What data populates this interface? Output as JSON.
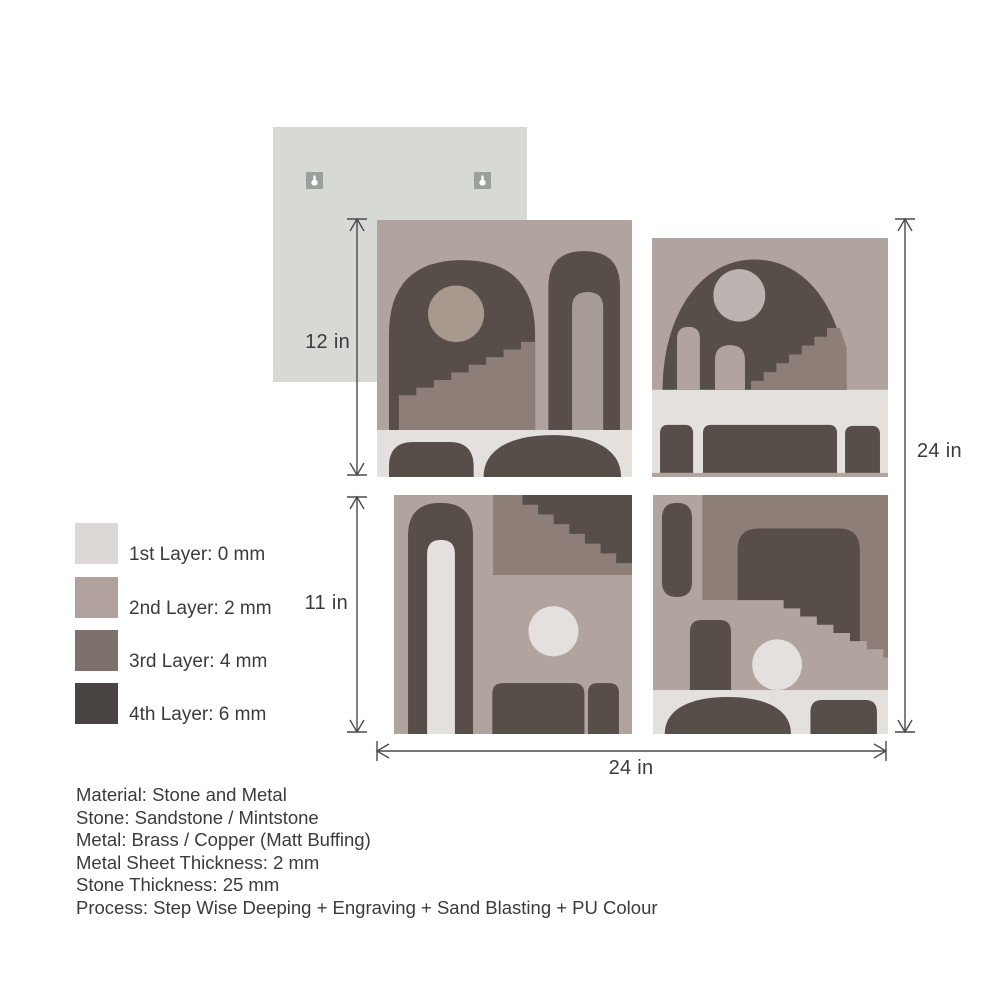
{
  "palette": {
    "layer1": "#e4e0dd",
    "layer2": "#b1a39e",
    "layer3": "#8d7e78",
    "layer4": "#574d49",
    "inner_arch": "#a79b96",
    "circle_dark_tile": "#a8998f",
    "circle_light": "#bcb2af",
    "legend1": "#dcd8d5",
    "legend2": "#b1a29d",
    "legend3": "#7e706b",
    "legend4": "#494341",
    "backing": "#d7d9d4",
    "hook": "#9aa09c",
    "line": "#4a4a4a",
    "text": "#3b3b3b"
  },
  "dimensions": {
    "top_left_tile_height": "12 in",
    "bottom_left_tile_height": "11 in",
    "total_height": "24 in",
    "total_width": "24 in"
  },
  "legend": {
    "items": [
      {
        "label": "1st Layer: 0 mm",
        "color": "#dcd8d5"
      },
      {
        "label": "2nd Layer: 2 mm",
        "color": "#b1a29d"
      },
      {
        "label": "3rd Layer: 4 mm",
        "color": "#7e706b"
      },
      {
        "label": "4th Layer: 6 mm",
        "color": "#494341"
      }
    ]
  },
  "specs": {
    "lines": [
      "Material: Stone and Metal",
      "Stone: Sandstone / Mintstone",
      "Metal: Brass / Copper (Matt Buffing)",
      "Metal Sheet Thickness: 2 mm",
      "Stone Thickness: 25 mm",
      "Process: Step Wise Deeping + Engraving + Sand Blasting + PU Colour"
    ]
  }
}
